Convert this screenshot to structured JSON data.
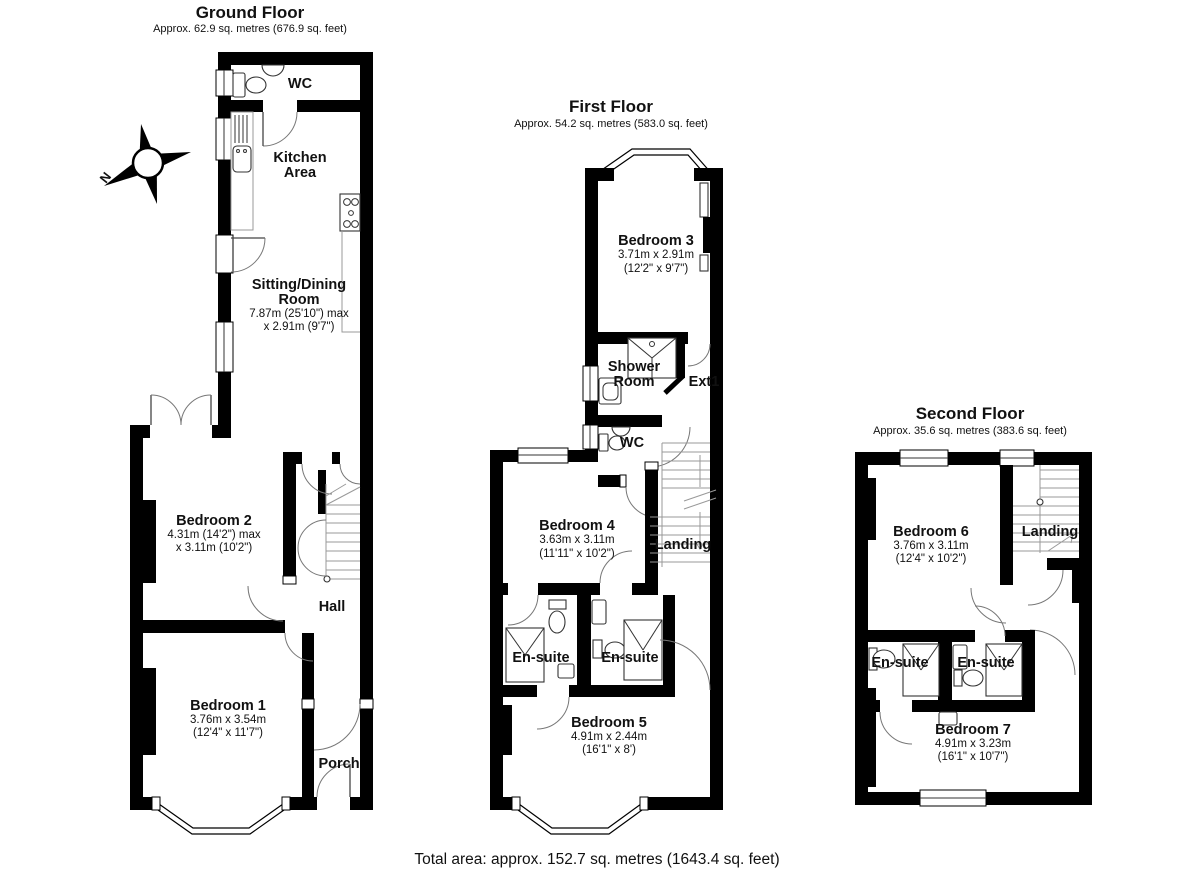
{
  "compass": {
    "north_label": "N"
  },
  "footer": {
    "total_area": "Total area: approx. 152.7 sq. metres (1643.4 sq. feet)"
  },
  "colors": {
    "wall": "#000000",
    "background": "#ffffff",
    "door_arc": "#777777",
    "stair_line": "#999999"
  },
  "floors": {
    "ground": {
      "title": "Ground Floor",
      "subtitle": "Approx. 62.9 sq. metres (676.9 sq. feet)",
      "labels": {
        "wc": "WC",
        "kitchen_l1": "Kitchen",
        "kitchen_l2": "Area",
        "sitting_l1": "Sitting/Dining",
        "sitting_l2": "Room",
        "sitting_d1": "7.87m (25'10\") max",
        "sitting_d2": "x 2.91m (9'7\")",
        "bedroom2": "Bedroom 2",
        "bedroom2_d1": "4.31m (14'2\") max",
        "bedroom2_d2": "x 3.11m (10'2\")",
        "hall": "Hall",
        "bedroom1": "Bedroom 1",
        "bedroom1_d1": "3.76m x 3.54m",
        "bedroom1_d2": "(12'4\" x 11'7\")",
        "porch": "Porch"
      }
    },
    "first": {
      "title": "First Floor",
      "subtitle": "Approx. 54.2 sq. metres (583.0 sq. feet)",
      "labels": {
        "bedroom3": "Bedroom 3",
        "bedroom3_d1": "3.71m x 2.91m",
        "bedroom3_d2": "(12'2\" x 9'7\")",
        "shower_l1": "Shower",
        "shower_l2": "Room",
        "ext1": "Ext1",
        "wc": "WC",
        "bedroom4": "Bedroom 4",
        "bedroom4_d1": "3.63m x 3.11m",
        "bedroom4_d2": "(11'11\" x 10'2\")",
        "landing": "Landing",
        "ensuite_left": "En-suite",
        "ensuite_right": "En-suite",
        "bedroom5": "Bedroom 5",
        "bedroom5_d1": "4.91m x 2.44m",
        "bedroom5_d2": "(16'1\" x 8')"
      }
    },
    "second": {
      "title": "Second Floor",
      "subtitle": "Approx. 35.6 sq. metres (383.6 sq. feet)",
      "labels": {
        "bedroom6": "Bedroom 6",
        "bedroom6_d1": "3.76m x 3.11m",
        "bedroom6_d2": "(12'4\" x 10'2\")",
        "landing": "Landing",
        "ensuite_left": "En-suite",
        "ensuite_right": "En-suite",
        "bedroom7": "Bedroom 7",
        "bedroom7_d1": "4.91m x 3.23m",
        "bedroom7_d2": "(16'1\" x 10'7\")"
      }
    }
  }
}
